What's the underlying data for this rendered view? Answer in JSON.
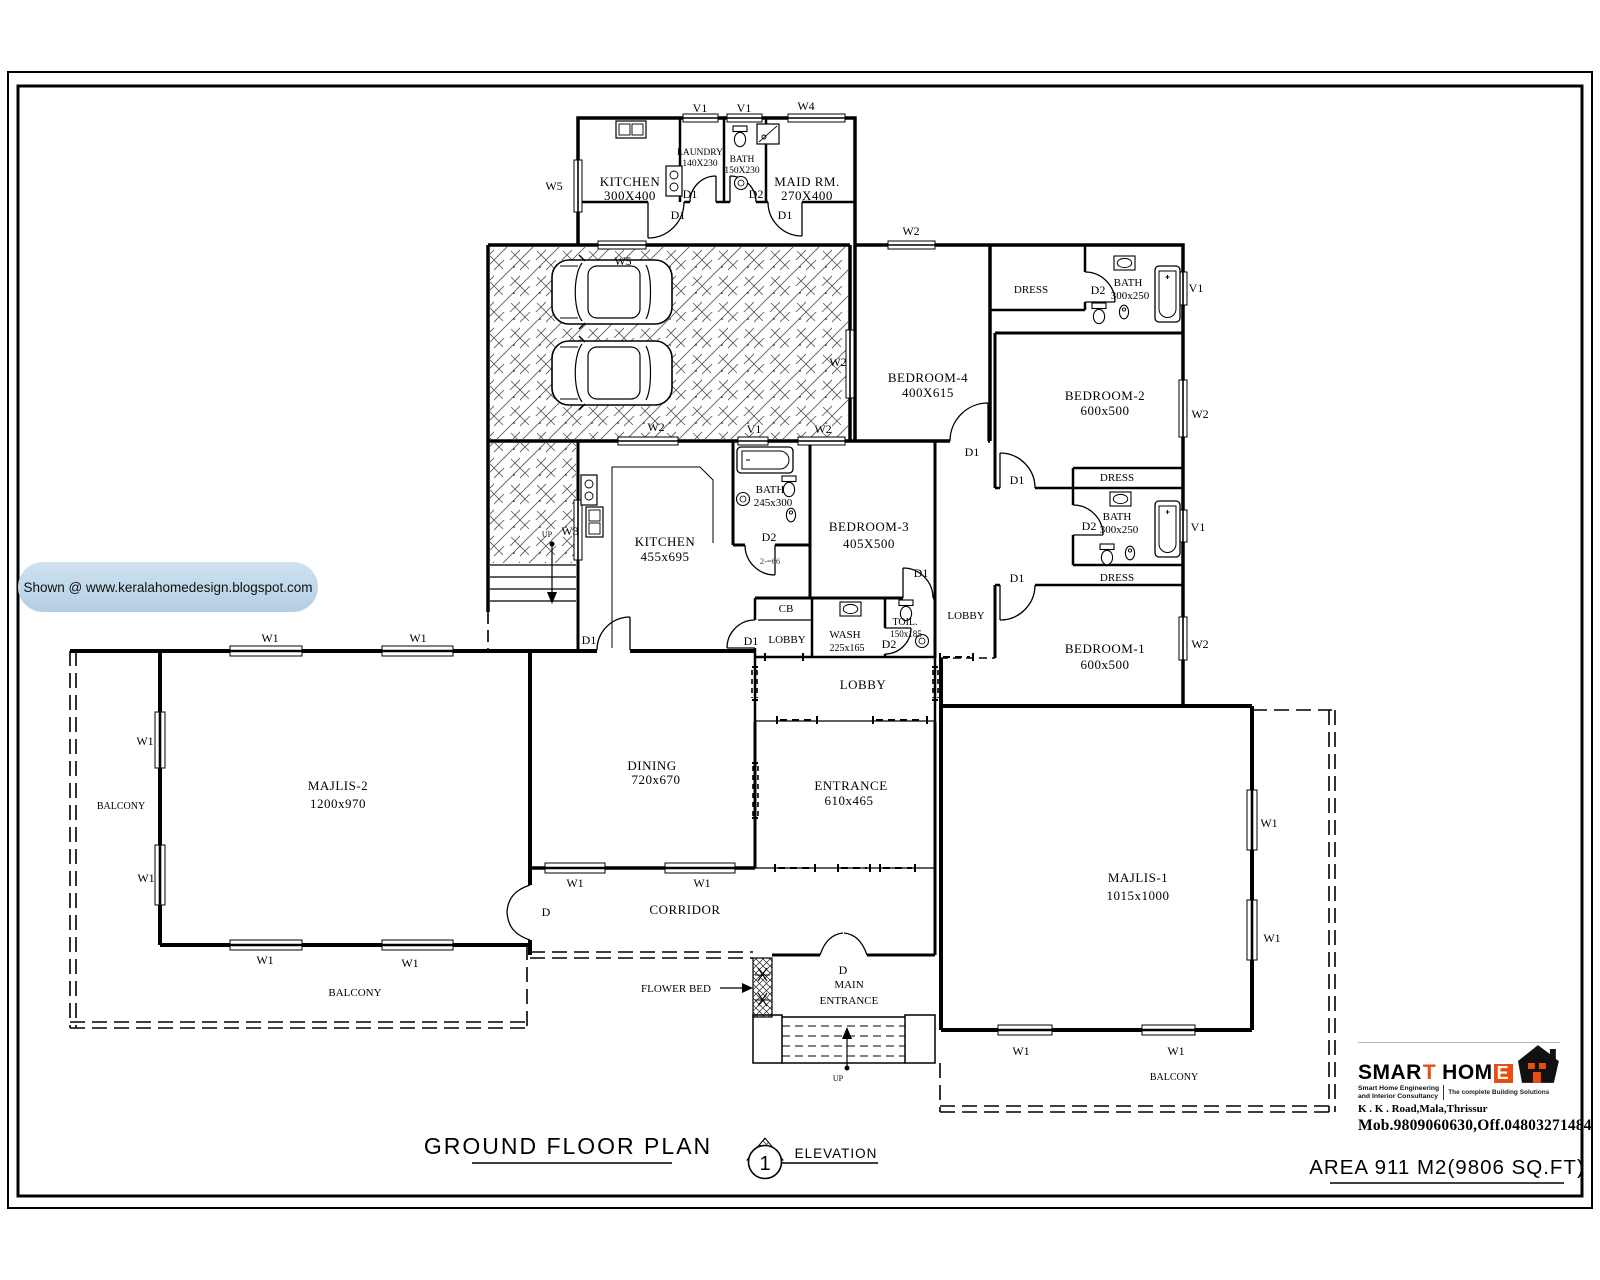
{
  "page": {
    "plan_title": "GROUND FLOOR PLAN",
    "elevation_label": "ELEVATION",
    "elevation_number": "1",
    "area_label": "AREA 911 M2(9806 SQ.FT)"
  },
  "watermark": {
    "text": "Shown @  www.keralahomedesign.blogspot.com"
  },
  "tags": {
    "w1": "W1",
    "w2": "W2",
    "w3": "W3",
    "w4": "W4",
    "w5": "W5",
    "v1": "V1",
    "d": "D",
    "d1": "D1",
    "d2": "D2",
    "up": "UP"
  },
  "rooms": {
    "kitchen_top": {
      "name": "KITCHEN",
      "dims": "300X400"
    },
    "laundry": {
      "name": "LAUNDRY",
      "dims": "140X230"
    },
    "bath_top": {
      "name": "BATH",
      "dims": "150X230"
    },
    "maid": {
      "name": "MAID  RM.",
      "dims": "270X400"
    },
    "bedroom4": {
      "name": "BEDROOM-4",
      "dims": "400X615"
    },
    "bedroom2": {
      "name": "BEDROOM-2",
      "dims": "600x500"
    },
    "bedroom3": {
      "name": "BEDROOM-3",
      "dims": "405X500"
    },
    "bedroom1": {
      "name": "BEDROOM-1",
      "dims": "600x500"
    },
    "bath_right_top": {
      "name": "BATH",
      "dims": "300x250"
    },
    "bath_right_mid": {
      "name": "BATH",
      "dims": "300x250"
    },
    "bath_inner": {
      "name": "BATH",
      "dims": "245x300"
    },
    "kitchen": {
      "name": "KITCHEN",
      "dims": "455x695"
    },
    "dress": "DRESS",
    "lobby": "LOBBY",
    "cb": "CB",
    "wash": {
      "name": "WASH",
      "dims": "225x165"
    },
    "toilet": {
      "name": "TOIL.",
      "dims": "150x185"
    },
    "majlis2": {
      "name": "MAJLIS-2",
      "dims": "1200x970"
    },
    "majlis1": {
      "name": "MAJLIS-1",
      "dims": "1015x1000"
    },
    "dining": {
      "name": "DINING",
      "dims": "720x670"
    },
    "entrance": {
      "name": "ENTRANCE",
      "dims": "610x465"
    },
    "corridor": "CORRIDOR",
    "balcony": "BALCONY",
    "main_entrance_line1": "MAIN",
    "main_entrance_line2": "ENTRANCE",
    "flower_bed": "FLOWER BED",
    "note": "2-=66"
  },
  "logo": {
    "brand_part1": "SMAR",
    "brand_t": "T",
    "brand_part2": "HOM",
    "brand_e": "E",
    "tagline_left_1": "Smart Home Engineering",
    "tagline_left_2": "and Interior Consultancy",
    "tagline_right": "The complete Building Solutions",
    "address": "K . K . Road,Mala,Thrissur",
    "phone": "Mob.9809060630,Off.04803271484",
    "accent": "#e84e0f"
  },
  "colors": {
    "ink": "#000000",
    "watermark_bg": "#b9d3e6",
    "paper": "#ffffff"
  }
}
